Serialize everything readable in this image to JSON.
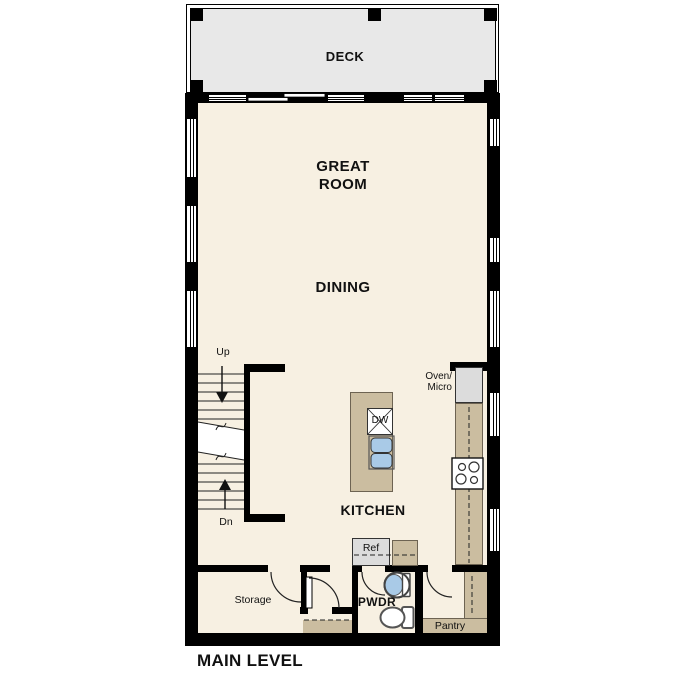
{
  "plan": {
    "level_title": "MAIN LEVEL",
    "rooms": {
      "deck": "DECK",
      "great_room": [
        "GREAT",
        "ROOM"
      ],
      "dining": "DINING",
      "kitchen": "KITCHEN",
      "powder": "PWDR",
      "storage": "Storage",
      "pantry": "Pantry"
    },
    "fixtures": {
      "ref": "Ref",
      "dishwasher": "DW",
      "oven_micro": [
        "Oven/",
        "Micro"
      ]
    },
    "stairs": {
      "up": "Up",
      "down": "Dn"
    }
  },
  "colors": {
    "floor": "#f7f0e2",
    "deck": "#e8e8e8",
    "casework": "#cbbda0",
    "appliance": "#dcdcdc",
    "fixture_blue": "#a9cae7",
    "wall": "#000000",
    "text": "#111111"
  }
}
